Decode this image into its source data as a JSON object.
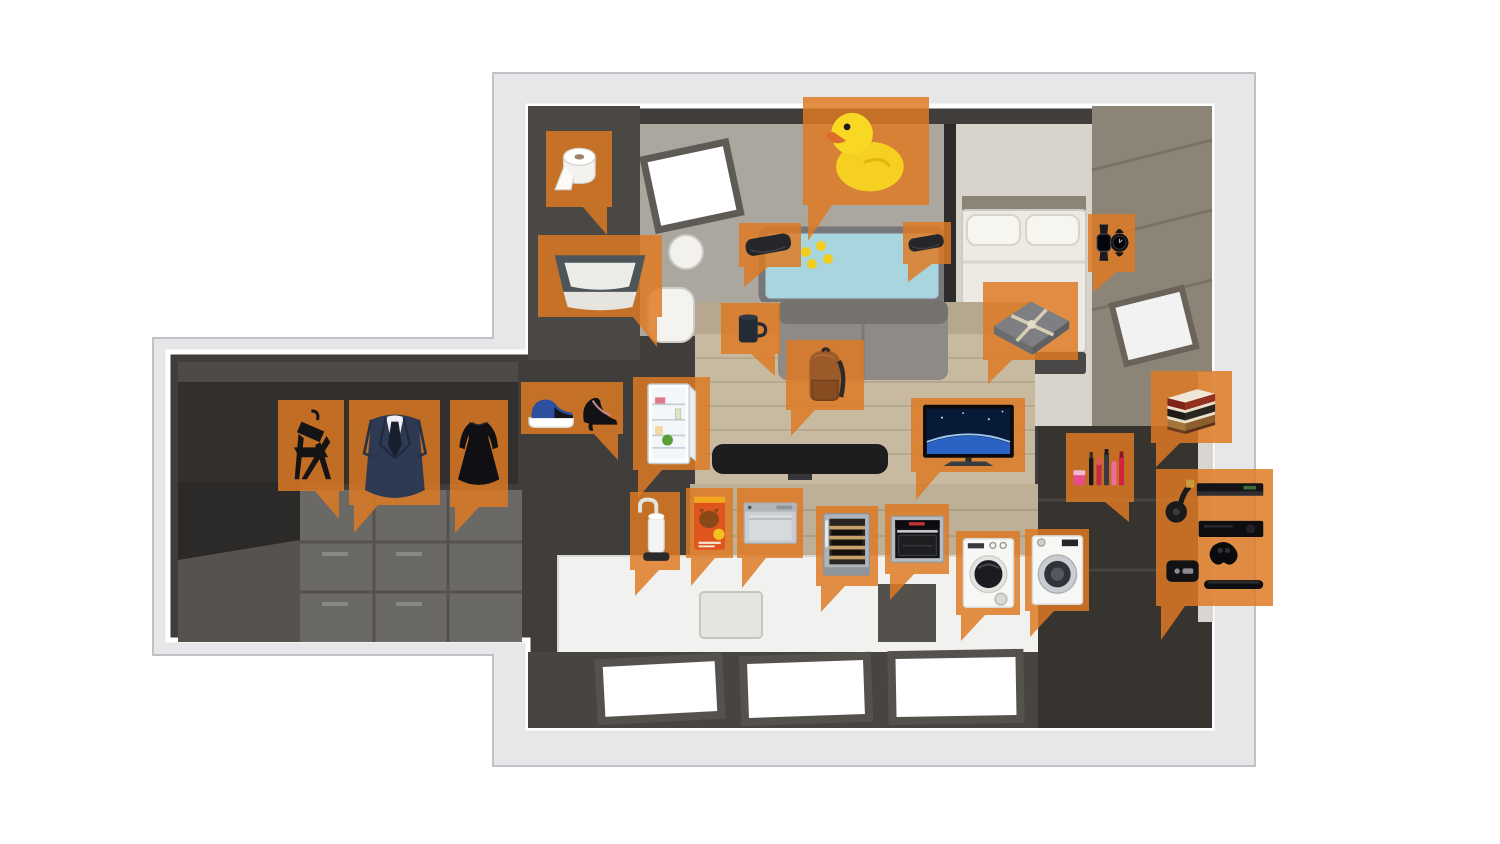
{
  "palette": {
    "background": "#FFFFFF",
    "callout_orange": "#DE7A22",
    "callout_opacity": 0.84,
    "shell_gray": "#E7E7E9",
    "wall_dark": "#403D3B",
    "floor_wood": "#C8BAA0",
    "bathtub_blue": "#A9D6DE",
    "bedroom_floor": "#D9D4CB",
    "taupe_wall": "#8D8478",
    "counter_white": "#F1F1EF"
  },
  "callouts": [
    {
      "id": "toilet-paper",
      "label": "toilet paper",
      "icon": "toilet-paper",
      "x": 546,
      "y": 131,
      "w": 66,
      "h": 76,
      "tail": "br",
      "th": 28
    },
    {
      "id": "litter-box",
      "label": "cat litter box",
      "icon": "litter-box",
      "x": 538,
      "y": 235,
      "w": 124,
      "h": 82,
      "tail": "br",
      "th": 30
    },
    {
      "id": "rubber-duck",
      "label": "rubber duck",
      "icon": "rubber-duck",
      "x": 803,
      "y": 97,
      "w": 126,
      "h": 108,
      "tail": "bl",
      "th": 36
    },
    {
      "id": "bath-pillow-left",
      "label": "bath pillow",
      "icon": "bath-pillow",
      "x": 739,
      "y": 223,
      "w": 62,
      "h": 44,
      "tail": "bl",
      "th": 20
    },
    {
      "id": "bath-pillow-right",
      "label": "bath pillow",
      "icon": "bath-pillow",
      "x": 903,
      "y": 222,
      "w": 48,
      "h": 42,
      "tail": "bl",
      "th": 18
    },
    {
      "id": "smartwatch",
      "label": "smartwatch",
      "icon": "watch",
      "x": 1088,
      "y": 214,
      "w": 47,
      "h": 58,
      "tail": "bl",
      "th": 20
    },
    {
      "id": "blanket",
      "label": "folded blanket",
      "icon": "blanket",
      "x": 983,
      "y": 282,
      "w": 95,
      "h": 78,
      "tail": "bl",
      "th": 24
    },
    {
      "id": "mug",
      "label": "mug",
      "icon": "mug",
      "x": 721,
      "y": 303,
      "w": 59,
      "h": 51,
      "tail": "br",
      "th": 22
    },
    {
      "id": "backpack",
      "label": "backpack",
      "icon": "backpack",
      "x": 786,
      "y": 340,
      "w": 78,
      "h": 70,
      "tail": "bl",
      "th": 26
    },
    {
      "id": "shoes",
      "label": "shoes",
      "icon": "shoes",
      "x": 521,
      "y": 382,
      "w": 102,
      "h": 52,
      "tail": "br",
      "th": 26
    },
    {
      "id": "fridge",
      "label": "refrigerator",
      "icon": "fridge",
      "x": 633,
      "y": 377,
      "w": 77,
      "h": 93,
      "tail": "bl",
      "th": 28
    },
    {
      "id": "folding-chair",
      "label": "folding chair",
      "icon": "chair",
      "x": 278,
      "y": 400,
      "w": 66,
      "h": 91,
      "tail": "br",
      "th": 28
    },
    {
      "id": "suit",
      "label": "suit",
      "icon": "suit",
      "x": 349,
      "y": 400,
      "w": 91,
      "h": 105,
      "tail": "bl",
      "th": 28
    },
    {
      "id": "dress",
      "label": "dress",
      "icon": "dress",
      "x": 450,
      "y": 400,
      "w": 58,
      "h": 107,
      "tail": "bl",
      "th": 26
    },
    {
      "id": "water-filter",
      "label": "water filter",
      "icon": "water-filter",
      "x": 630,
      "y": 492,
      "w": 50,
      "h": 78,
      "tail": "bl",
      "th": 26
    },
    {
      "id": "cat-food",
      "label": "cat food bag",
      "icon": "cat-food",
      "x": 686,
      "y": 488,
      "w": 47,
      "h": 70,
      "tail": "bl",
      "th": 28
    },
    {
      "id": "dishwasher",
      "label": "countertop dishwasher",
      "icon": "dishwasher",
      "x": 737,
      "y": 488,
      "w": 66,
      "h": 70,
      "tail": "bl",
      "th": 30
    },
    {
      "id": "wine-cooler",
      "label": "wine cooler",
      "icon": "wine-cooler",
      "x": 816,
      "y": 506,
      "w": 62,
      "h": 80,
      "tail": "bl",
      "th": 26
    },
    {
      "id": "oven",
      "label": "oven",
      "icon": "oven",
      "x": 885,
      "y": 504,
      "w": 64,
      "h": 70,
      "tail": "bl",
      "th": 26
    },
    {
      "id": "dryer",
      "label": "tumble dryer",
      "icon": "dryer",
      "x": 956,
      "y": 531,
      "w": 64,
      "h": 84,
      "tail": "bl",
      "th": 26
    },
    {
      "id": "washer",
      "label": "washing machine",
      "icon": "washer",
      "x": 1025,
      "y": 529,
      "w": 64,
      "h": 82,
      "tail": "bl",
      "th": 26
    },
    {
      "id": "tv",
      "label": "television",
      "icon": "tv",
      "x": 911,
      "y": 398,
      "w": 114,
      "h": 74,
      "tail": "bl",
      "th": 28
    },
    {
      "id": "makeup",
      "label": "makeup",
      "icon": "makeup",
      "x": 1066,
      "y": 433,
      "w": 68,
      "h": 69,
      "tail": "br",
      "th": 20
    },
    {
      "id": "books",
      "label": "books",
      "icon": "books",
      "x": 1151,
      "y": 371,
      "w": 81,
      "h": 72,
      "tail": "bl",
      "th": 24
    },
    {
      "id": "media-devices",
      "label": "media devices and game console",
      "icon": "media-devices",
      "x": 1156,
      "y": 469,
      "w": 117,
      "h": 137,
      "tail": "bl",
      "th": 34
    }
  ]
}
